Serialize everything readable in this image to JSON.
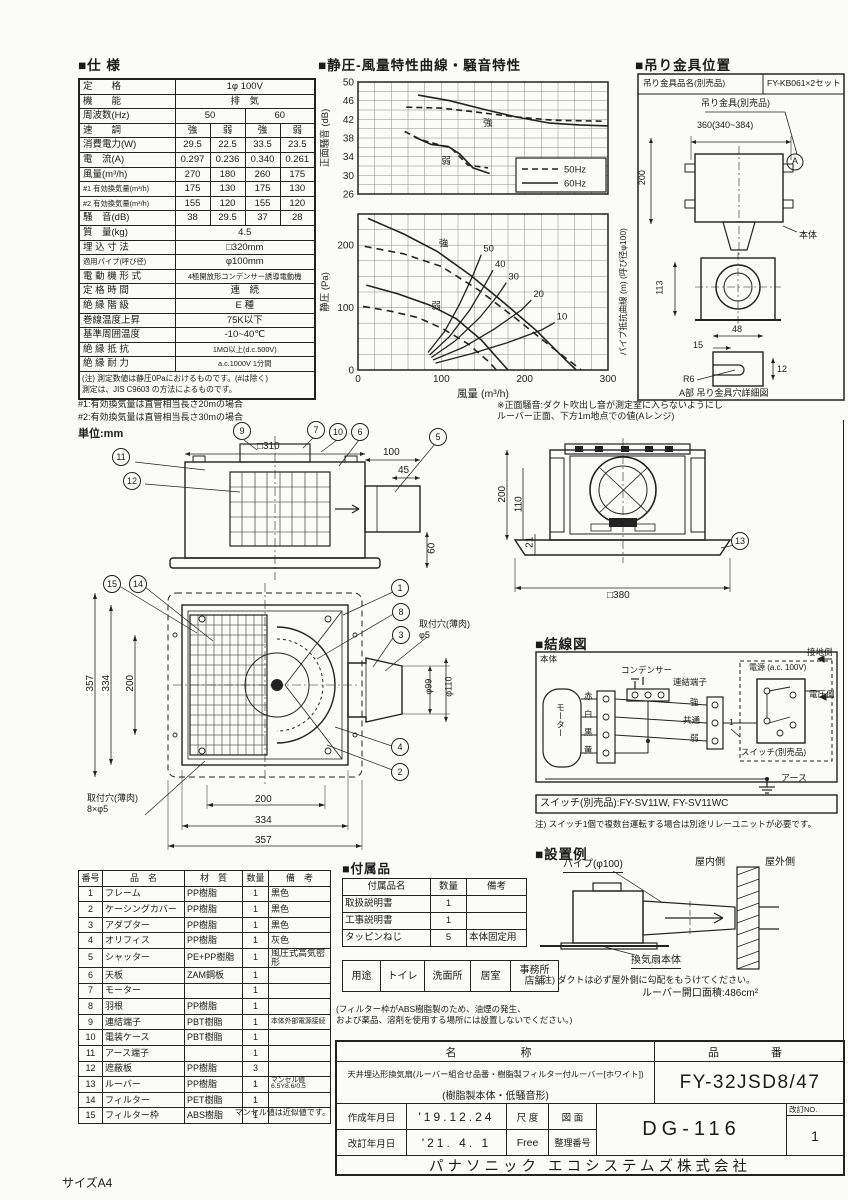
{
  "page": {
    "size_label": "サイズA4",
    "unit_label": "単位:mm"
  },
  "spec": {
    "title": "■仕 様",
    "rows": [
      {
        "label": "定　　格",
        "cells": [
          "1φ 100V"
        ]
      },
      {
        "label": "機　　能",
        "cells": [
          "排　気"
        ]
      },
      {
        "label": "周波数(Hz)",
        "cells": [
          "50",
          "60"
        ]
      },
      {
        "label": "速　　調",
        "cells": [
          "強",
          "弱",
          "強",
          "弱"
        ]
      },
      {
        "label": "消費電力(W)",
        "cells": [
          "29.5",
          "22.5",
          "33.5",
          "23.5"
        ]
      },
      {
        "label": "電　流(A)",
        "cells": [
          "0.297",
          "0.236",
          "0.340",
          "0.261"
        ]
      },
      {
        "label": "風量(m³/h)",
        "cells": [
          "270",
          "180",
          "260",
          "175"
        ]
      },
      {
        "label": "#1 有効換気量(m³/h)",
        "cells": [
          "175",
          "130",
          "175",
          "130"
        ]
      },
      {
        "label": "#2 有効換気量(m³/h)",
        "cells": [
          "155",
          "120",
          "155",
          "120"
        ]
      },
      {
        "label": "騒　音(dB)",
        "cells": [
          "38",
          "29.5",
          "37",
          "28"
        ]
      },
      {
        "label": "質　量(kg)",
        "cells": [
          "4.5"
        ]
      },
      {
        "label": "埋 込 寸 法",
        "cells": [
          "□320mm"
        ]
      },
      {
        "label": "適用パイプ(呼び径)",
        "cells": [
          "φ100mm"
        ]
      },
      {
        "label": "電 動 機 形 式",
        "cells": [
          "4極開放形コンデンサー誘導電動機"
        ]
      },
      {
        "label": "定 格 時 間",
        "cells": [
          "連　続"
        ]
      },
      {
        "label": "絶 縁 階 級",
        "cells": [
          "E 種"
        ]
      },
      {
        "label": "巻線温度上昇",
        "cells": [
          "75K以下"
        ]
      },
      {
        "label": "基準周囲温度",
        "cells": [
          "-10~40℃"
        ]
      },
      {
        "label": "絶 縁 抵 抗",
        "cells": [
          "1MΩ以上(d.c.500V)"
        ]
      },
      {
        "label": "絶 縁 耐 力",
        "cells": [
          "a.c.1000V 1分間"
        ]
      }
    ],
    "note": "(注) 測定数値は静圧0Paにおけるものです。(#は除く)\n測定は、JIS C9603 の方法によるものです。",
    "footnote1": "#1:有効換気量は直管相当長さ20mの場合",
    "footnote2": "#2:有効換気量は直管相当長さ30mの場合"
  },
  "charts": {
    "title": "■静圧-風量特性曲線・騒音特性",
    "front_noise_note": "※正面騒音:ダクト吹出し音が測定室に入らないようにし\nルーバー正面、下方1m地点での値(Aレンジ)"
  },
  "chart_data": [
    {
      "type": "line",
      "id": "noise",
      "ylabel": "正面騒音 (dB)",
      "ylim": [
        26,
        50
      ],
      "yticks": [
        26,
        30,
        34,
        38,
        42,
        46,
        50
      ],
      "ygrid": 2,
      "xlim": [
        0,
        300
      ],
      "xgrid": 20,
      "legend": [
        {
          "label": "50Hz",
          "dash": "6 4"
        },
        {
          "label": "60Hz",
          "dash": ""
        }
      ],
      "series": [
        {
          "name": "strong-60Hz",
          "dash": "",
          "points": [
            [
              72,
              47.2
            ],
            [
              110,
              46
            ],
            [
              150,
              44.2
            ],
            [
              190,
              42.5
            ],
            [
              230,
              41.2
            ],
            [
              265,
              40.8
            ],
            [
              300,
              40.6
            ]
          ],
          "label": "強",
          "label_at": [
            150,
            40.6
          ]
        },
        {
          "name": "strong-50Hz",
          "dash": "6 4",
          "points": [
            [
              58,
              44.6
            ],
            [
              100,
              44.4
            ],
            [
              140,
              43.6
            ],
            [
              185,
              42.6
            ],
            [
              235,
              41.8
            ],
            [
              295,
              41.6
            ]
          ]
        },
        {
          "name": "weak-60Hz",
          "dash": "",
          "points": [
            [
              68,
              38.2
            ],
            [
              88,
              36.6
            ],
            [
              108,
              36.2
            ],
            [
              122,
              34.6
            ],
            [
              138,
              31.6
            ],
            [
              158,
              30.4
            ]
          ],
          "label": "弱",
          "label_at": [
            100,
            32.4
          ]
        },
        {
          "name": "weak-50Hz",
          "dash": "6 4",
          "points": [
            [
              56,
              39.4
            ],
            [
              76,
              37.6
            ],
            [
              96,
              36.6
            ],
            [
              112,
              35.8
            ],
            [
              132,
              32.2
            ],
            [
              156,
              31.6
            ]
          ]
        }
      ]
    },
    {
      "type": "line",
      "id": "pq",
      "xlabel": "風量 (m³/h)",
      "ylabel": "静圧 (Pa)",
      "ylabel2": "パイプ抵抗曲線 (m) (呼び径φ100)",
      "xlim": [
        0,
        300
      ],
      "ylim": [
        0,
        250
      ],
      "xticks": [
        0,
        100,
        200,
        300
      ],
      "yticks": [
        0,
        100,
        200
      ],
      "xgrid": 20,
      "ygrid": 25,
      "series": [
        {
          "name": "strong-60Hz",
          "dash": "",
          "points": [
            [
              12,
              243
            ],
            [
              55,
              218
            ],
            [
              95,
              190
            ],
            [
              135,
              152
            ],
            [
              175,
              108
            ],
            [
              215,
              62
            ],
            [
              250,
              15
            ],
            [
              262,
              0
            ]
          ],
          "label": "強",
          "label_at": [
            97,
            198
          ]
        },
        {
          "name": "strong-50Hz",
          "dash": "7 5",
          "points": [
            [
              8,
              198
            ],
            [
              55,
              186
            ],
            [
              100,
              166
            ],
            [
              145,
              128
            ],
            [
              190,
              82
            ],
            [
              235,
              34
            ],
            [
              268,
              0
            ]
          ]
        },
        {
          "name": "weak-60Hz",
          "dash": "",
          "points": [
            [
              10,
              136
            ],
            [
              48,
              122
            ],
            [
              86,
              104
            ],
            [
              118,
              82
            ],
            [
              148,
              48
            ],
            [
              172,
              12
            ],
            [
              180,
              0
            ]
          ],
          "label": "弱",
          "label_at": [
            88,
            98
          ]
        },
        {
          "name": "weak-50Hz",
          "dash": "7 5",
          "points": [
            [
              6,
              102
            ],
            [
              40,
              94
            ],
            [
              72,
              84
            ],
            [
              102,
              66
            ],
            [
              132,
              42
            ],
            [
              158,
              12
            ],
            [
              166,
              0
            ]
          ]
        }
      ],
      "resistance": [
        {
          "label": "50",
          "points": [
            [
              84,
              28
            ],
            [
              104,
              62
            ],
            [
              122,
              106
            ],
            [
              138,
              152
            ],
            [
              148,
              185
            ]
          ]
        },
        {
          "label": "40",
          "points": [
            [
              86,
              24
            ],
            [
              110,
              54
            ],
            [
              134,
              96
            ],
            [
              152,
              136
            ],
            [
              162,
              160
            ]
          ]
        },
        {
          "label": "30",
          "points": [
            [
              88,
              20
            ],
            [
              116,
              46
            ],
            [
              146,
              84
            ],
            [
              168,
              120
            ],
            [
              178,
              140
            ]
          ]
        },
        {
          "label": "20",
          "points": [
            [
              90,
              16
            ],
            [
              126,
              36
            ],
            [
              164,
              66
            ],
            [
              196,
              96
            ],
            [
              208,
              112
            ]
          ]
        },
        {
          "label": "10",
          "points": [
            [
              93,
              11
            ],
            [
              136,
              26
            ],
            [
              180,
              44
            ],
            [
              220,
              64
            ],
            [
              236,
              76
            ]
          ]
        }
      ]
    }
  ],
  "bracket": {
    "title": "■吊り金具位置",
    "part_label": "吊り金具品名(別売品)",
    "part_no": "FY-KB061×2セット",
    "bracket_label": "吊り金具(別売品)",
    "dim_200": "200",
    "dim_360": "360(340~384)",
    "a_mark": "A",
    "body": "本体",
    "dim_113": "113",
    "dim_48": "48",
    "dim_15": "15",
    "r6": "R6",
    "dim_12": "12",
    "caption": "A部 吊り金具穴詳細図"
  },
  "drawings": {
    "side_view": {
      "callouts": [
        "11",
        "12",
        "9",
        "7",
        "10",
        "6",
        "5"
      ],
      "dims": {
        "width": "□310",
        "depth": "100",
        "depth2": "45",
        "height": "60"
      }
    },
    "rear_view": {
      "callouts": [
        "13"
      ],
      "dims": {
        "h200": "200",
        "h110": "110",
        "h21": "21",
        "width": "□380"
      }
    },
    "front_view": {
      "callouts": [
        "15",
        "14",
        "1",
        "8",
        "3",
        "4",
        "2"
      ],
      "dims": {
        "v357": "357",
        "v334": "334",
        "v200": "200",
        "h200": "200",
        "h334": "334",
        "h357": "357",
        "hole_top": "取付穴(薄肉)\nφ5",
        "d99": "φ99",
        "d110": "φ110",
        "hole_bottom": "取付穴(薄肉)\n8×φ5"
      }
    }
  },
  "wiring": {
    "title": "■結線図",
    "body_label": "本体",
    "motor": "モーター",
    "condenser": "コンデンサー",
    "terminal": "連結端子",
    "wire_red": "赤",
    "wire_white": "白",
    "wire_black": "黒",
    "wire_yellow": "黄",
    "sp_high": "強",
    "sp_common": "共通",
    "sp_low": "弱",
    "one": "1",
    "ground_side": "接地側",
    "power": "電源 (a.c. 100V)",
    "voltage_side": "電圧側",
    "switch_label": "スイッチ(別売品)",
    "earth": "アース",
    "switch_models": "スイッチ(別売品):FY-SV11W, FY-SV11WC",
    "note": "注) スイッチ1個で複数台運転する場合は別途リレーユニットが必要です。"
  },
  "install": {
    "title": "■設置例",
    "pipe": "パイプ(φ100)",
    "indoor": "屋内側",
    "outdoor": "屋外側",
    "body": "換気扇本体",
    "note": "注) ダクトは必ず屋外側に勾配をもうけてください。",
    "louver_area": "ルーバー開口面積:486cm²"
  },
  "parts": {
    "header": [
      "番号",
      "品　名",
      "材　質",
      "数量",
      "備　考"
    ],
    "rows": [
      [
        "1",
        "フレーム",
        "PP樹脂",
        "1",
        "黒色"
      ],
      [
        "2",
        "ケーシングカバー",
        "PP樹脂",
        "1",
        "黒色"
      ],
      [
        "3",
        "アダプター",
        "PP樹脂",
        "1",
        "黒色"
      ],
      [
        "4",
        "オリフィス",
        "PP樹脂",
        "1",
        "灰色"
      ],
      [
        "5",
        "シャッター",
        "PE+PP樹脂",
        "1",
        "風圧式高気密形"
      ],
      [
        "6",
        "天板",
        "ZAM鋼板",
        "1",
        ""
      ],
      [
        "7",
        "モーター",
        "",
        "1",
        ""
      ],
      [
        "8",
        "羽根",
        "PP樹脂",
        "1",
        ""
      ],
      [
        "9",
        "連結端子",
        "PBT樹脂",
        "1",
        "本体外部電源接続"
      ],
      [
        "10",
        "電装ケース",
        "PBT樹脂",
        "1",
        ""
      ],
      [
        "11",
        "アース端子",
        "",
        "1",
        ""
      ],
      [
        "12",
        "遮蔽板",
        "PP樹脂",
        "3",
        ""
      ],
      [
        "13",
        "ルーバー",
        "PP樹脂",
        "1",
        "マンセル値6.5Y8.6/0.5"
      ],
      [
        "14",
        "フィルター",
        "PET樹脂",
        "1",
        ""
      ],
      [
        "15",
        "フィルター枠",
        "ABS樹脂",
        "1",
        ""
      ]
    ],
    "note": "マンセル値は近似値です。"
  },
  "accessories": {
    "title": "■付属品",
    "header": [
      "付属品名",
      "数量",
      "備考"
    ],
    "rows": [
      [
        "取扱説明書",
        "1",
        ""
      ],
      [
        "工事説明書",
        "1",
        ""
      ],
      [
        "タッピンねじ",
        "5",
        "本体固定用"
      ]
    ]
  },
  "usage": {
    "label": "用途",
    "cells": [
      "トイレ",
      "洗面所",
      "居室",
      "事務所\n店舗"
    ]
  },
  "filter_note": "(フィルター枠がABS樹脂製のため、油煙の発生、\nおよび薬品、溶剤を使用する場所には設置しないでください。)",
  "titleblock": {
    "name_header": "名　　称",
    "pn_header": "品　　番",
    "name1": "天井埋込形換気扇(ルーバー組合せ品番・樹脂製フィルター付ルーバー[ホワイト])",
    "name2": "(樹脂製本体・低騒音形)",
    "part_no": "FY-32JSD8/47",
    "created_label": "作成年月日",
    "created": "'19.12.24",
    "revised_label": "改訂年月日",
    "revised": "'21. 4. 1",
    "scale_label": "尺 度",
    "scale": "Free",
    "drawing_label": "図 面",
    "ref_label": "整理番号",
    "drawing_no": "DG-116",
    "rev_label": "改訂NO.",
    "rev": "1",
    "company": "パナソニック エコシステムズ株式会社"
  }
}
